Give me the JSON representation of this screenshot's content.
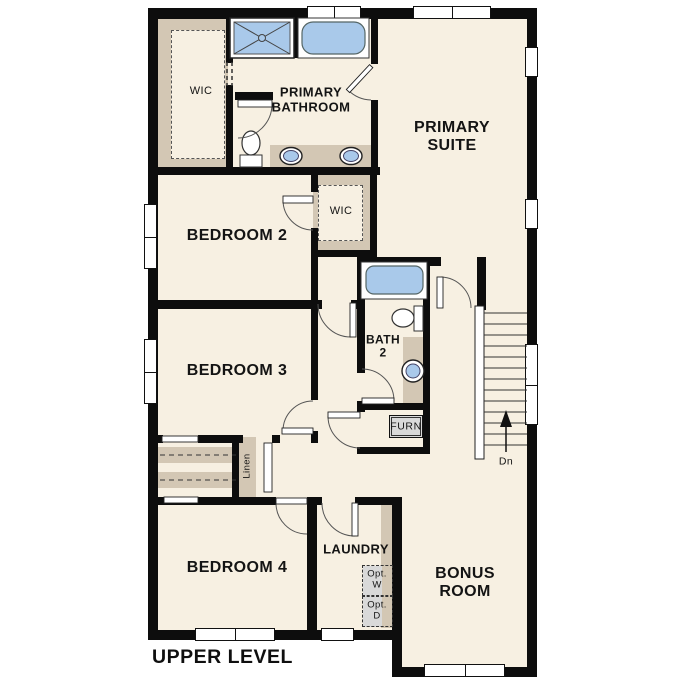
{
  "plan": {
    "level_title": "UPPER LEVEL",
    "rooms": {
      "primary_suite": "PRIMARY\nSUITE",
      "primary_bathroom": "PRIMARY\nBATHROOM",
      "primary_wic": "WIC",
      "bedroom_2": "BEDROOM 2",
      "hall_wic": "WIC",
      "bedroom_3": "BEDROOM 3",
      "bath_2": "BATH\n2",
      "furnace": "FURN",
      "linen": "Linen",
      "bedroom_4": "BEDROOM 4",
      "laundry": "LAUNDRY",
      "bonus_room": "BONUS\nROOM"
    },
    "stairs": {
      "annotation": "Dn"
    },
    "laundry_options": {
      "washer": "Opt.\nW",
      "dryer": "Opt.\nD"
    },
    "colors": {
      "floor": "#f7f0e2",
      "closet_tan": "#d3c7b4",
      "fixture_blue": "#a9c9ea",
      "wall": "#0d0d0d",
      "appliance_gray": "#d9d9d9"
    }
  }
}
